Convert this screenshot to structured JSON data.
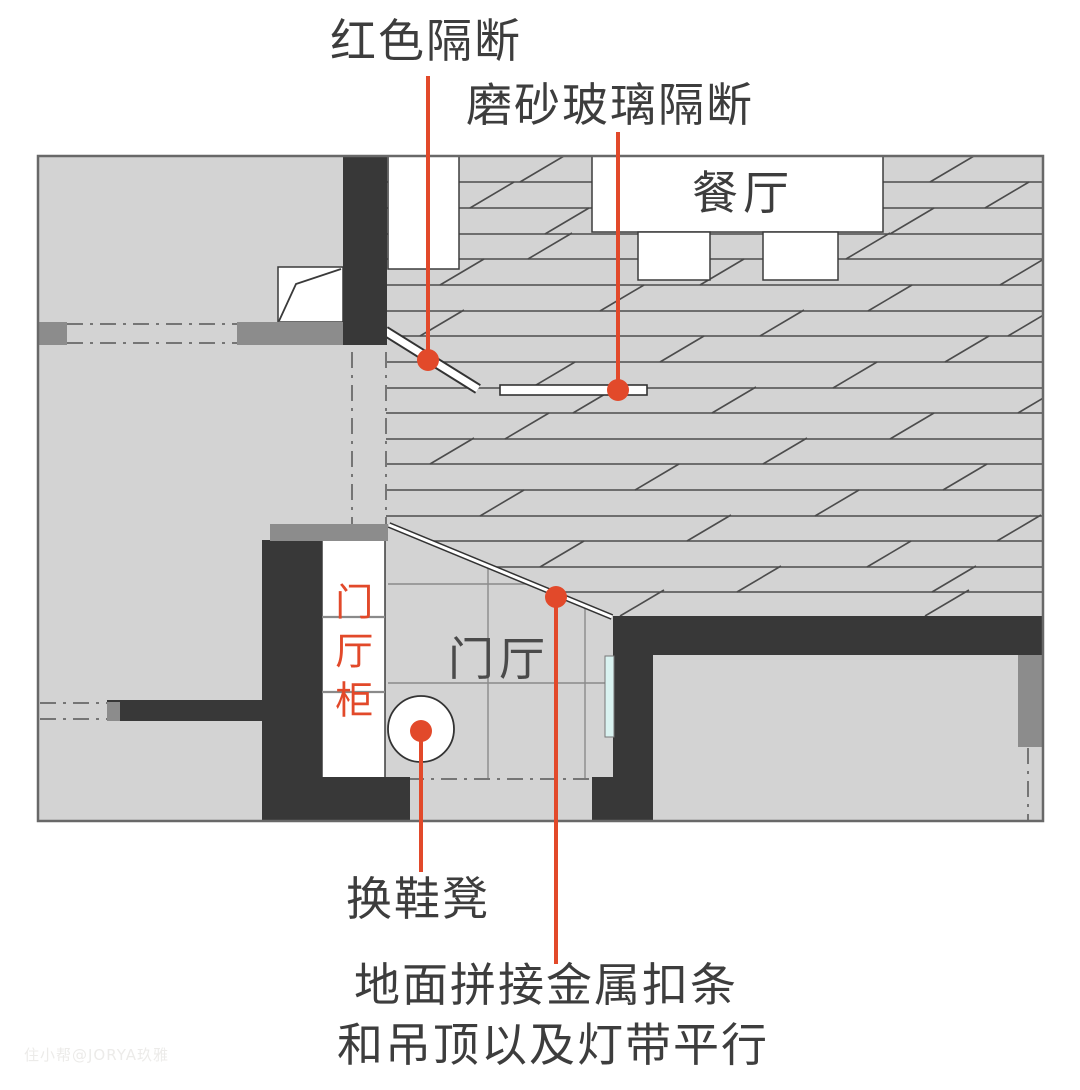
{
  "plan": {
    "type": "entry-foyer-floor-plan",
    "rooms": {
      "dining_label": "餐厅",
      "foyer_label": "门厅",
      "foyer_cabinet_label": "门厅柜"
    },
    "annotations": {
      "red_partition": "红色隔断",
      "frosted_glass_partition": "磨砂玻璃隔断",
      "shoe_stool": "换鞋凳",
      "metal_strip_line1": "地面拼接金属扣条",
      "metal_strip_line2": "和吊顶以及灯带平行"
    },
    "colors": {
      "accent_red": "#e2492a",
      "wall_dark": "#383838",
      "wall_medium": "#8c8c8c",
      "floor_gray": "#d3d3d3",
      "glass_door_cyan": "#d9f2f0",
      "label_ink": "#3d3d3d"
    }
  },
  "watermark": "住小帮@JORYA玖雅"
}
